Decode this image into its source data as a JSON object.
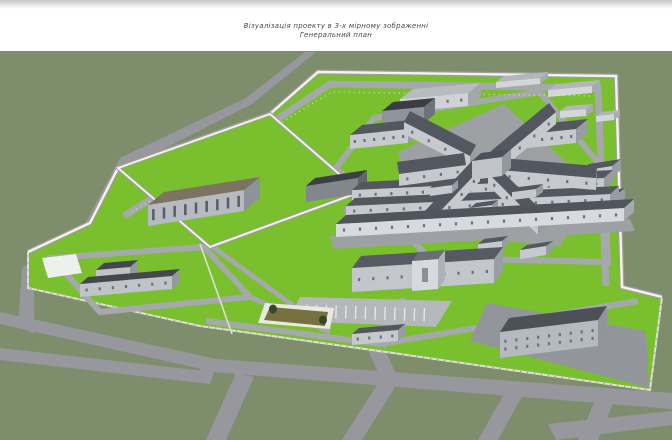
{
  "header": {
    "title_line1": "Візуалізація проекту в 3-х мірному зображенні",
    "title_line2": "Генеральний план"
  },
  "palette": {
    "top_strip": "#cccccc",
    "field": "#7e8e6d",
    "grass": "#79bf2e",
    "road_outer": "#97979d",
    "road_inner": "#a6a9ab",
    "wall_top": "#f5f4ec",
    "wall_face": "#9d9d99",
    "yard_wall": "#f3f2ea",
    "fence": "#dfdfd6",
    "fence_posts": "#8b8b85",
    "apron": "#92969b",
    "apron_light": "#9da1a4",
    "pond": "#77713f",
    "pond_rim": "#e9e9e1",
    "bush": "#39442c",
    "parking": "#b4b8ba",
    "stripe": "#e8eaea",
    "pad": "#eef0ed",
    "title_color": "#4a4a4a"
  },
  "scene": {
    "defaults": {
      "roof": "#53575f",
      "wall": "#c6cacf",
      "side": "#989da3",
      "winc": "#6b7077"
    },
    "buildings": [
      {
        "name": "shed-ne-1",
        "A": [
          496,
          88
        ],
        "B": [
          540,
          84
        ],
        "D": [
          8,
          -6
        ],
        "h": 6,
        "roof": "#b3b7bb",
        "wall": "#d4d7da",
        "side": "#a8acb0"
      },
      {
        "name": "shed-ne-2",
        "A": [
          548,
          97
        ],
        "B": [
          592,
          93
        ],
        "D": [
          8,
          -6
        ],
        "h": 7,
        "roof": "#b3b7bb",
        "wall": "#d4d7da",
        "side": "#a8acb0"
      },
      {
        "name": "shed-ne-3",
        "A": [
          560,
          118
        ],
        "B": [
          586,
          116
        ],
        "D": [
          7,
          -5
        ],
        "h": 7,
        "roof": "#b3b7bb",
        "wall": "#d4d7da",
        "side": "#a8acb0"
      },
      {
        "name": "shed-ne-4",
        "A": [
          596,
          122
        ],
        "B": [
          614,
          120
        ],
        "D": [
          6,
          -4
        ],
        "h": 6,
        "roof": "#b3b7bb",
        "wall": "#d4d7da",
        "side": "#a8acb0"
      },
      {
        "name": "warehouse-north",
        "A": [
          400,
          112
        ],
        "B": [
          468,
          106
        ],
        "D": [
          13,
          -10
        ],
        "h": 13,
        "roof": "#b8bcc0",
        "wall": "#cfd3d6",
        "side": "#a2a7ac",
        "win": 5
      },
      {
        "name": "boiler-house",
        "A": [
          382,
          127
        ],
        "B": [
          424,
          123
        ],
        "D": [
          11,
          -9
        ],
        "h": 16,
        "roof": "#3a3e44",
        "wall": "#8f949a",
        "side": "#6e7379"
      },
      {
        "name": "block-west",
        "A": [
          350,
          149
        ],
        "B": [
          408,
          143
        ],
        "D": [
          12,
          -10
        ],
        "h": 14,
        "win": 6
      },
      {
        "name": "block-east",
        "A": [
          518,
          149
        ],
        "B": [
          576,
          143
        ],
        "D": [
          12,
          -10
        ],
        "h": 14,
        "win": 6
      },
      {
        "name": "rows-east-1",
        "A": [
          580,
          182
        ],
        "B": [
          612,
          177
        ],
        "D": [
          9,
          -7
        ],
        "h": 11,
        "win": 4
      },
      {
        "name": "rows-east-2",
        "A": [
          588,
          210
        ],
        "B": [
          616,
          205
        ],
        "D": [
          9,
          -7
        ],
        "h": 10,
        "win": 4
      },
      {
        "name": "dark-hall",
        "A": [
          306,
          202
        ],
        "B": [
          358,
          194
        ],
        "D": [
          9,
          -8
        ],
        "h": 16,
        "roof": "#3c4046",
        "wall": "#82878e",
        "side": "#62676e"
      },
      {
        "name": "industrial-hall",
        "A": [
          148,
          226
        ],
        "B": [
          244,
          211
        ],
        "D": [
          16,
          -13
        ],
        "h": 21,
        "roof": "#7c7363",
        "wall": "#b7bbc1",
        "side": "#8e939a",
        "win": 9,
        "ww": 2.5,
        "wh": 11,
        "winc": "#585d64"
      },
      {
        "name": "cellblock-row-1",
        "A": [
          352,
          201
        ],
        "B": [
          604,
          189
        ],
        "D": [
          9,
          -8
        ],
        "h": 11,
        "win": 16
      },
      {
        "name": "cellblock-row-2",
        "A": [
          346,
          217
        ],
        "B": [
          610,
          205
        ],
        "D": [
          9,
          -8
        ],
        "h": 11,
        "win": 16
      },
      {
        "name": "star-wing-upleft",
        "A": [
          404,
          134
        ],
        "B": [
          470,
          168
        ],
        "D": [
          6,
          -11
        ],
        "h": 12,
        "win": 4
      },
      {
        "name": "star-wing-upright",
        "A": [
          498,
          172
        ],
        "B": [
          556,
          124
        ],
        "D": [
          -7,
          -9
        ],
        "h": 12,
        "win": 4
      },
      {
        "name": "star-wing-left",
        "A": [
          399,
          186
        ],
        "B": [
          466,
          177
        ],
        "D": [
          -2,
          -12
        ],
        "h": 12,
        "win": 4
      },
      {
        "name": "star-wing-right",
        "A": [
          500,
          182
        ],
        "B": [
          596,
          190
        ],
        "D": [
          1,
          -12
        ],
        "h": 12,
        "win": 5
      },
      {
        "name": "star-wing-downleft",
        "A": [
          431,
          233
        ],
        "B": [
          480,
          181
        ],
        "D": [
          -8,
          -8
        ],
        "h": 12,
        "win": 4
      },
      {
        "name": "star-wing-downright",
        "A": [
          488,
          185
        ],
        "B": [
          538,
          235
        ],
        "D": [
          8,
          -8
        ],
        "h": 12,
        "win": 4
      },
      {
        "name": "star-hub",
        "A": [
          472,
          180
        ],
        "B": [
          502,
          176
        ],
        "D": [
          9,
          -8
        ],
        "h": 19,
        "roof": "#4c5058",
        "wall": "#c0c4c9",
        "side": "#93989e"
      },
      {
        "name": "star-annex-1",
        "A": [
          430,
          196
        ],
        "B": [
          452,
          193
        ],
        "D": [
          6,
          -5
        ],
        "h": 8
      },
      {
        "name": "star-annex-2",
        "A": [
          512,
          200
        ],
        "B": [
          536,
          197
        ],
        "D": [
          7,
          -5
        ],
        "h": 8
      },
      {
        "name": "star-annex-3",
        "A": [
          470,
          216
        ],
        "B": [
          492,
          213
        ],
        "D": [
          6,
          -5
        ],
        "h": 8
      },
      {
        "name": "cellblock-row-3",
        "A": [
          336,
          237
        ],
        "B": [
          624,
          221
        ],
        "D": [
          10,
          -9
        ],
        "h": 13,
        "roof": "#50545c",
        "wall": "#d7dade",
        "side": "#a5aaaf",
        "win": 18
      },
      {
        "name": "service-block-1",
        "A": [
          478,
          253
        ],
        "B": [
          502,
          250
        ],
        "D": [
          6,
          -5
        ],
        "h": 9
      },
      {
        "name": "service-block-2",
        "A": [
          520,
          259
        ],
        "B": [
          546,
          255
        ],
        "D": [
          7,
          -5
        ],
        "h": 9
      },
      {
        "name": "admin-building",
        "A": [
          352,
          292
        ],
        "B": [
          494,
          283
        ],
        "D": [
          9,
          -12
        ],
        "h": 24,
        "roof": "#565a62",
        "wall": "#c3c7cb",
        "side": "#999ea4",
        "win": 10
      },
      {
        "name": "admin-portal",
        "A": [
          412,
          291
        ],
        "B": [
          438,
          289
        ],
        "D": [
          7,
          -9
        ],
        "h": 30,
        "roof": "#6a6e76",
        "wall": "#d6d9dd",
        "side": "#aeb2b7",
        "win": 1,
        "ww": 6,
        "wh": 14,
        "winc": "#8b9096"
      },
      {
        "name": "annex-wing",
        "A": [
          96,
          285
        ],
        "B": [
          130,
          282
        ],
        "D": [
          8,
          -7
        ],
        "h": 15,
        "roof": "#44484e",
        "wall": "#c0c4c8",
        "side": "#94999e"
      },
      {
        "name": "annex-building",
        "A": [
          80,
          297
        ],
        "B": [
          172,
          289
        ],
        "D": [
          8,
          -7
        ],
        "h": 13,
        "roof": "#44484e",
        "wall": "#c0c4c8",
        "side": "#94999e",
        "win": 7
      },
      {
        "name": "gatehouse",
        "A": [
          352,
          345
        ],
        "B": [
          398,
          341
        ],
        "D": [
          7,
          -6
        ],
        "h": 11,
        "win": 4
      },
      {
        "name": "dormitory",
        "A": [
          500,
          358
        ],
        "B": [
          598,
          346
        ],
        "D": [
          9,
          -14
        ],
        "h": 26,
        "roof": "#4c5057",
        "wall": "#b5bac0",
        "side": "#8f959b",
        "win": 9,
        "rows": 2
      }
    ]
  }
}
